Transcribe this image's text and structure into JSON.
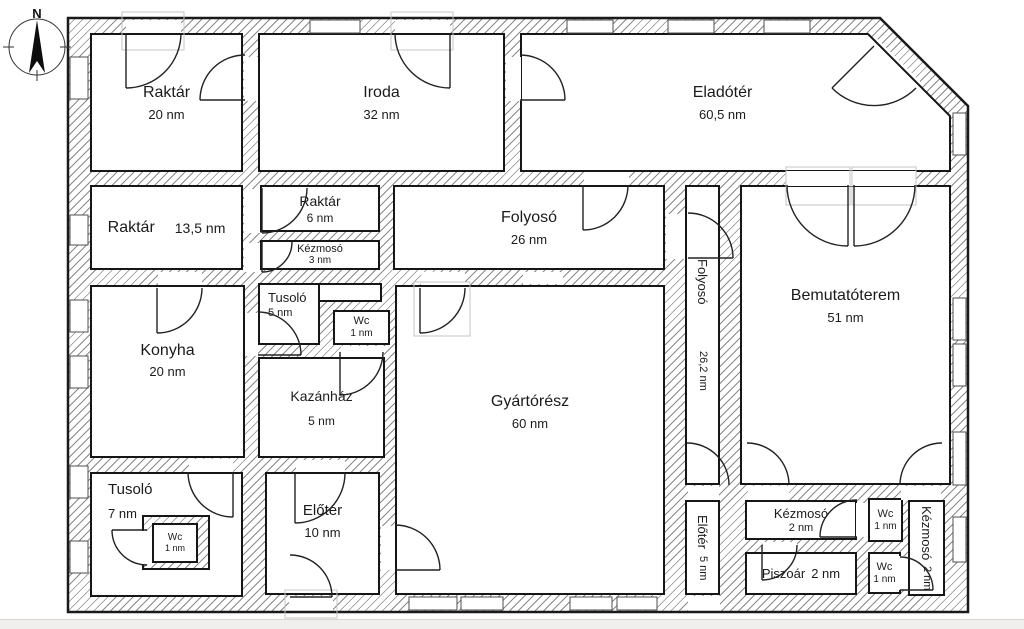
{
  "compass": {
    "north_label": "N"
  },
  "rooms": [
    {
      "key": "raktar-20",
      "name": "Raktár",
      "area": "20 nm"
    },
    {
      "key": "iroda",
      "name": "Iroda",
      "area": "32 nm"
    },
    {
      "key": "eladoter",
      "name": "Eladótér",
      "area": "60,5 nm"
    },
    {
      "key": "raktar-13-5",
      "name": "Raktár",
      "area": "13,5 nm"
    },
    {
      "key": "raktar-6",
      "name": "Raktár",
      "area": "6 nm"
    },
    {
      "key": "kezmoso-3",
      "name": "Kézmosó",
      "area": "3 nm"
    },
    {
      "key": "folyoso-26",
      "name": "Folyosó",
      "area": "26 nm"
    },
    {
      "key": "folyoso-26-2",
      "name": "Folyosó",
      "area": "26,2 nm"
    },
    {
      "key": "bemutatoterem",
      "name": "Bemutatóterem",
      "area": "51 nm"
    },
    {
      "key": "konyha",
      "name": "Konyha",
      "area": "20 nm"
    },
    {
      "key": "tusolo-5",
      "name": "Tusoló",
      "area": "5 nm"
    },
    {
      "key": "wc-1a",
      "name": "Wc",
      "area": "1 nm"
    },
    {
      "key": "kazanhaz",
      "name": "Kazánház",
      "area": "5 nm"
    },
    {
      "key": "gyartoresz",
      "name": "Gyártórész",
      "area": "60 nm"
    },
    {
      "key": "tusolo-7",
      "name": "Tusoló",
      "area": "7 nm"
    },
    {
      "key": "wc-1b",
      "name": "Wc",
      "area": "1 nm"
    },
    {
      "key": "eloter-10",
      "name": "Előtér",
      "area": "10 nm"
    },
    {
      "key": "eloter-5",
      "name": "Előtér",
      "area": "5 nm"
    },
    {
      "key": "kezmoso-2a",
      "name": "Kézmosó",
      "area": "2 nm"
    },
    {
      "key": "wc-1c",
      "name": "Wc",
      "area": "1 nm"
    },
    {
      "key": "kezmoso-2b",
      "name": "Kézmosó",
      "area": "2 nm"
    },
    {
      "key": "piszoar",
      "name": "Piszoár",
      "area": "2 nm"
    },
    {
      "key": "wc-1d",
      "name": "Wc",
      "area": "1 nm"
    }
  ],
  "colors": {
    "wall_hatch": "#8a8a8a",
    "outline": "#1a1a1a",
    "text": "#1b1b1b",
    "door_frame": "#c4c4c4",
    "page_strip": "#f1efee"
  }
}
